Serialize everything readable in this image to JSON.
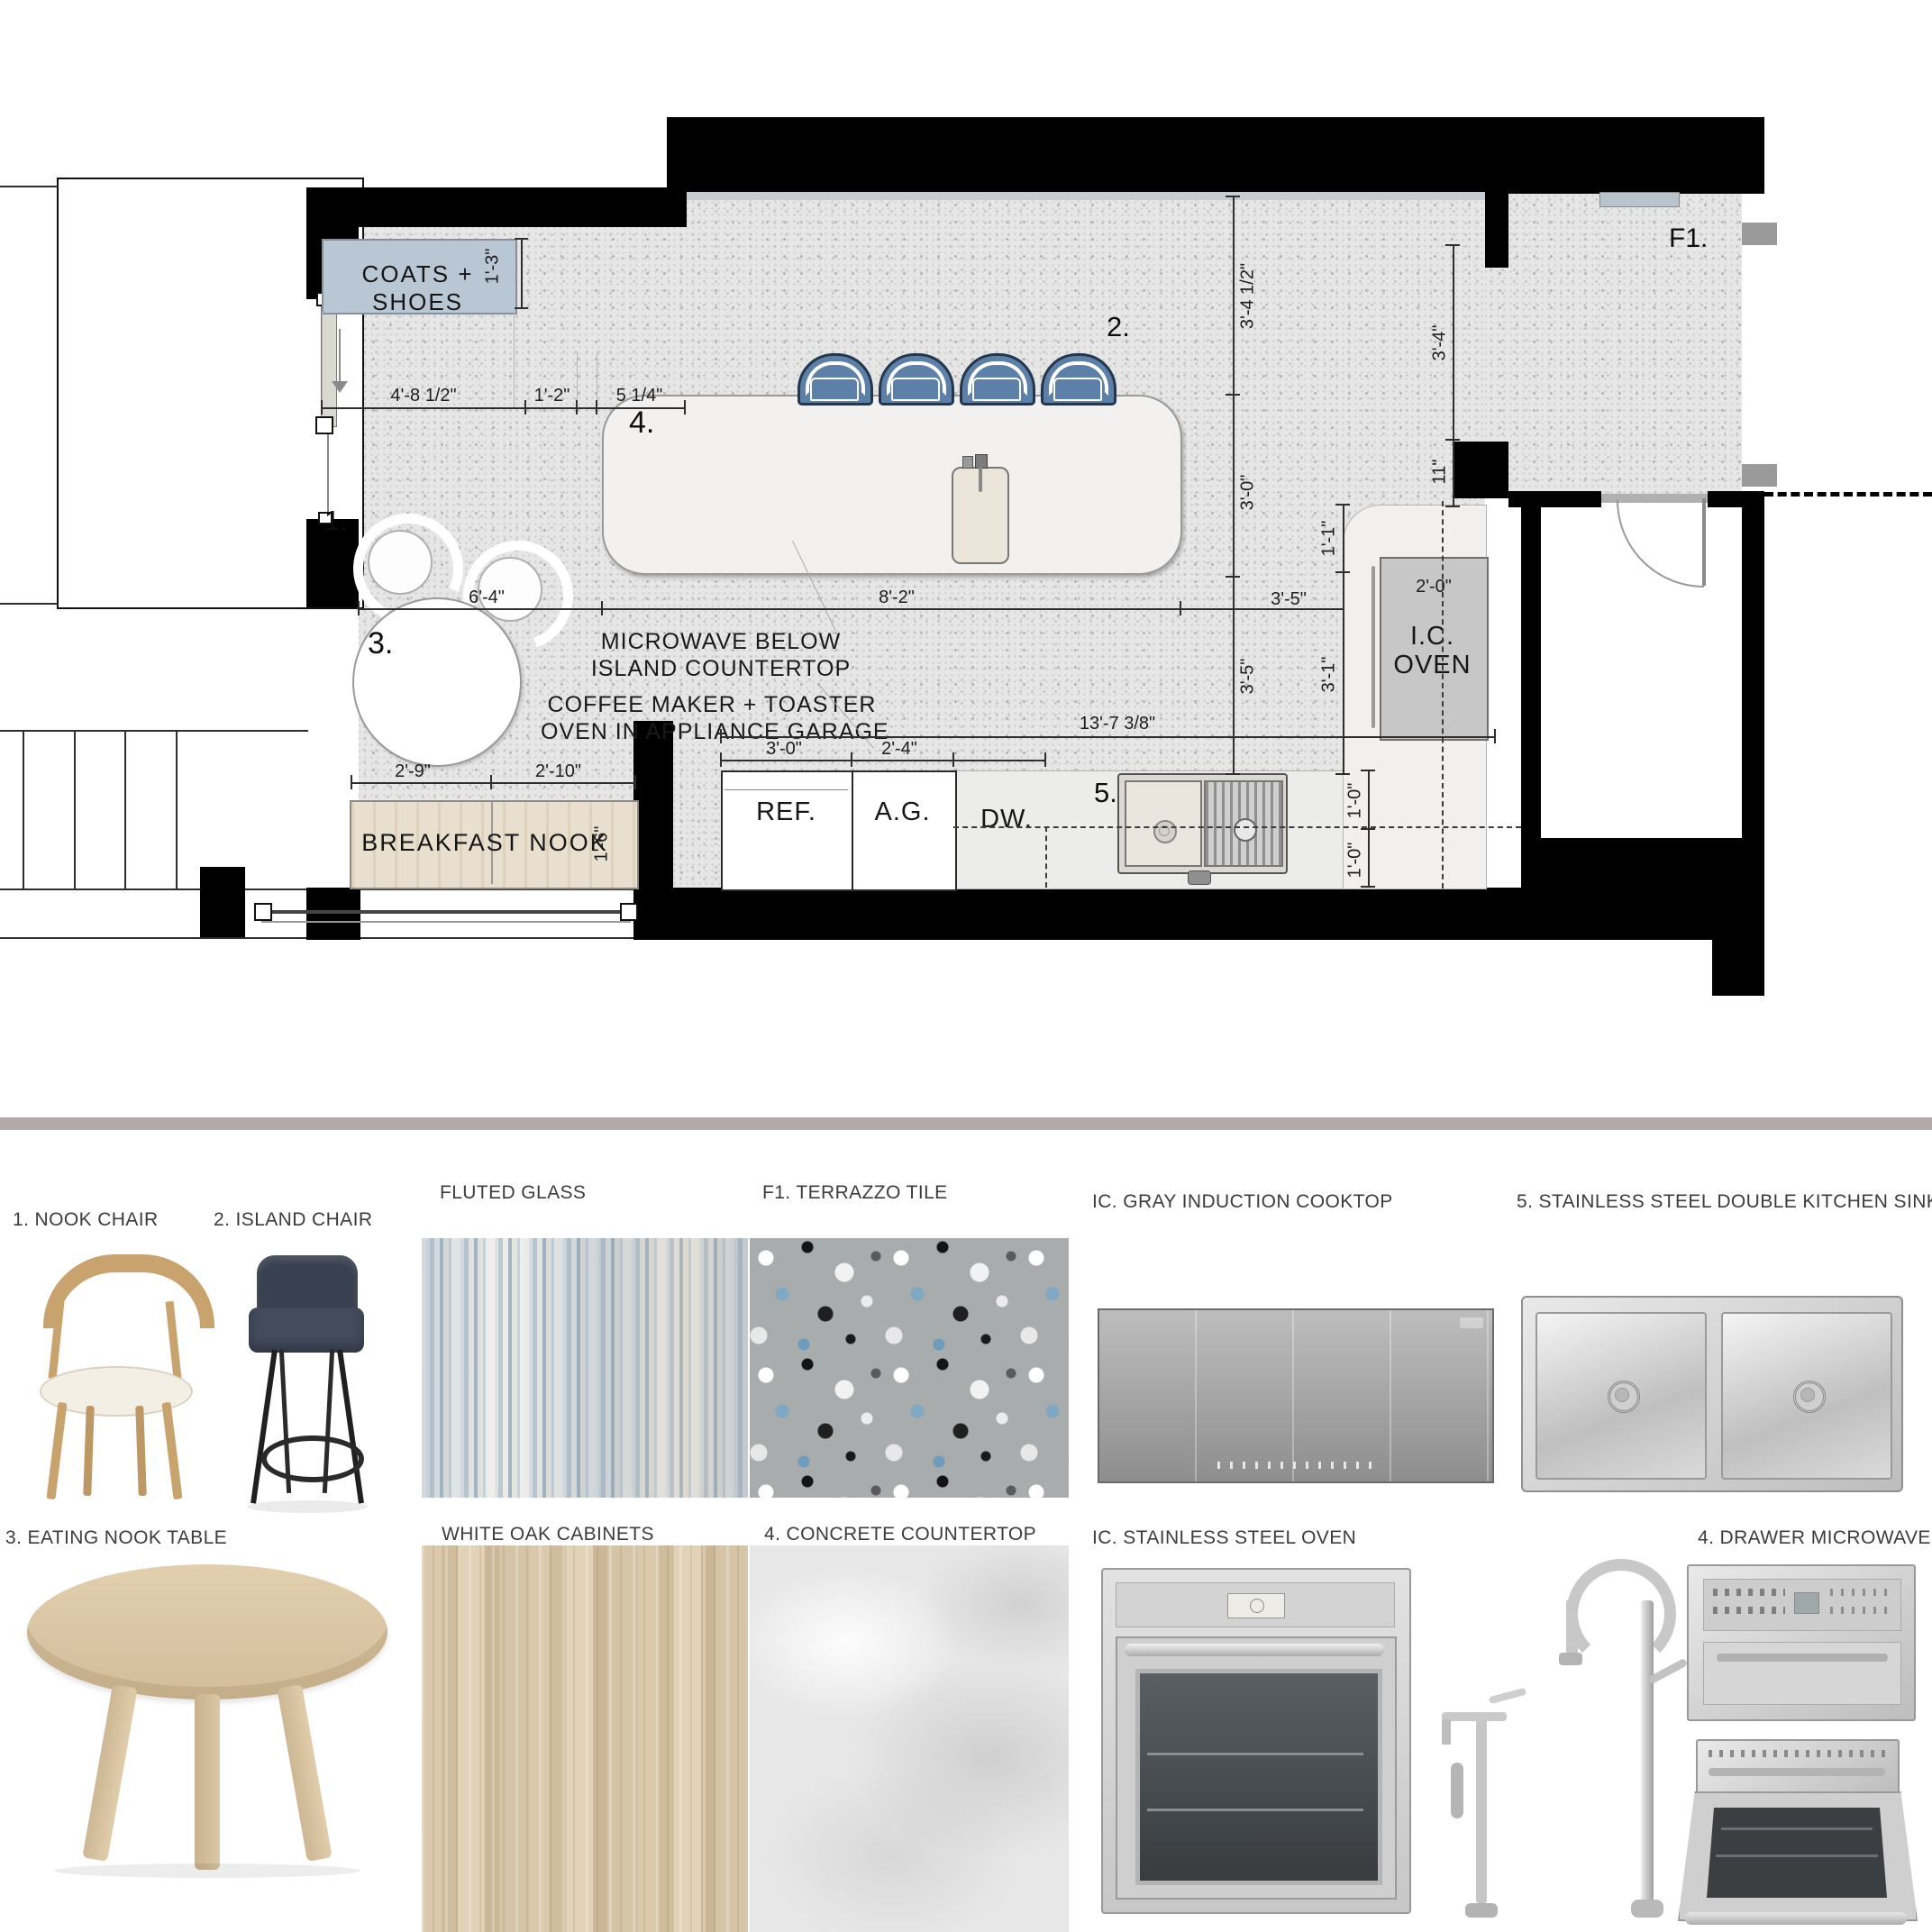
{
  "plan": {
    "labels": {
      "coats": "COATS + SHOES",
      "breakfast_nook": "BREAKFAST NOOK",
      "ref": "REF.",
      "ag": "A.G.",
      "dw": "DW.",
      "ic_line1": "I.C.",
      "ic_line2": "OVEN",
      "f1": "F1."
    },
    "markers": {
      "nook_chair": "1.",
      "island_chair": "2.",
      "nook_table": "3.",
      "island": "4.",
      "sink": "5."
    },
    "notes": {
      "microwave_1": "MICROWAVE BELOW",
      "microwave_2": "ISLAND COUNTERTOP",
      "coffee_1": "COFFEE MAKER + TOASTER",
      "coffee_2": "OVEN IN APPLIANCE GARAGE"
    },
    "dims": {
      "coats_width": "4'-8 1/2\"",
      "coats_gap": "1'-2\"",
      "coats_side": "5 1/4\"",
      "coats_depth": "1'-3\"",
      "clearance_top": "3'-4 1/2\"",
      "island_clearance": "3'-0\"",
      "entry_opening": "3'-4\"",
      "entry_jamb": "11\"",
      "counter_corner": "1'-1\"",
      "counter_depth": "2'-0\"",
      "aisle_a": "3'-5\"",
      "aisle_b": "3'-5\"",
      "aisle_c": "3'-1\"",
      "nook_width": "6'-4\"",
      "island_length": "8'-2\"",
      "run_total": "13'-7 3/8\"",
      "ref_width": "3'-0\"",
      "ag_width": "2'-4\"",
      "bench_a": "2'-9\"",
      "bench_b": "2'-10\"",
      "bench_depth": "1'-6\"",
      "counter_a": "1'-0\"",
      "counter_b": "1'-0\""
    }
  },
  "board": {
    "items": [
      {
        "label": "1. NOOK CHAIR"
      },
      {
        "label": "2. ISLAND CHAIR"
      },
      {
        "label": "FLUTED GLASS"
      },
      {
        "label": "F1. TERRAZZO TILE"
      },
      {
        "label": "IC. GRAY INDUCTION COOKTOP"
      },
      {
        "label": "5. STAINLESS STEEL DOUBLE KITCHEN SINK"
      },
      {
        "label": "3. EATING NOOK TABLE"
      },
      {
        "label": "WHITE OAK CABINETS"
      },
      {
        "label": "4. CONCRETE COUNTERTOP"
      },
      {
        "label": "IC. STAINLESS STEEL OVEN"
      },
      {
        "label": "4. DRAWER MICROWAVE"
      }
    ]
  },
  "colors": {
    "wall": "#000000",
    "floor_terrazzo_base": "#e6e6e6",
    "coats_cabinet": "#b9c6d3",
    "island_chair_blue": "#5d80a9",
    "bench_wood": "#e9dfcf",
    "divider_taupe": "#b3a9a9",
    "appliance_gray": "#c7c7c7"
  }
}
